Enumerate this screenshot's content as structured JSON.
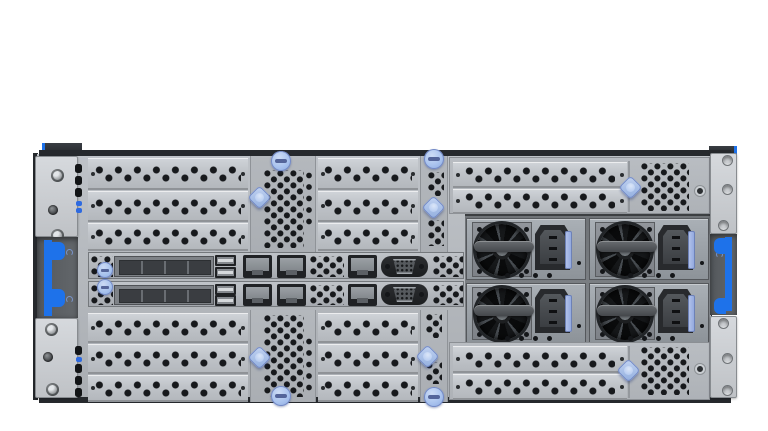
{
  "scene": {
    "title": "4U rack server rear view",
    "background": "#ffffff"
  },
  "colors": {
    "edge": "#26292d",
    "hole": "#17191c",
    "accent": "#1e72ea",
    "widget": "#a8c2ee",
    "widget-hi": "#cddcf5",
    "widget-border": "#7389c5"
  },
  "components": {
    "rack_ears": {
      "left": {
        "screws_top": 3,
        "screws_bottom": 3,
        "release_handle_color": "blue"
      },
      "right": {
        "finger_holes_top": 3,
        "finger_holes_bottom": 3,
        "release_handle_color": "blue"
      }
    },
    "slot_covers": {
      "upper_left_bank": 3,
      "upper_mid_bank": 3,
      "lower_left_bank": 3,
      "lower_mid_bank": 3,
      "upper_riser": 2,
      "lower_riser": 2,
      "style": "perforated-blank"
    },
    "io_rows": [
      {
        "id": "io-row-1",
        "bay_cells": 4,
        "usb_ports": 2,
        "ethernet_ports": 3,
        "vga_ports": 1,
        "latch": "blue-round"
      },
      {
        "id": "io-row-2",
        "bay_cells": 4,
        "usb_ports": 2,
        "ethernet_ports": 3,
        "vga_ports": 1,
        "latch": "blue-round"
      }
    ],
    "power_supplies": [
      {
        "id": "psu-1",
        "fan": true,
        "inlet": "C14",
        "release_tab": "blue"
      },
      {
        "id": "psu-2",
        "fan": true,
        "inlet": "C14",
        "release_tab": "blue"
      },
      {
        "id": "psu-3",
        "fan": true,
        "inlet": "C14",
        "release_tab": "blue"
      },
      {
        "id": "psu-4",
        "fan": true,
        "inlet": "C14",
        "release_tab": "blue"
      }
    ],
    "blue_thumbscrews": 4,
    "blue_diamond_latches": 6,
    "status_leds": {
      "top_column": 5,
      "bottom_column": 5
    }
  }
}
